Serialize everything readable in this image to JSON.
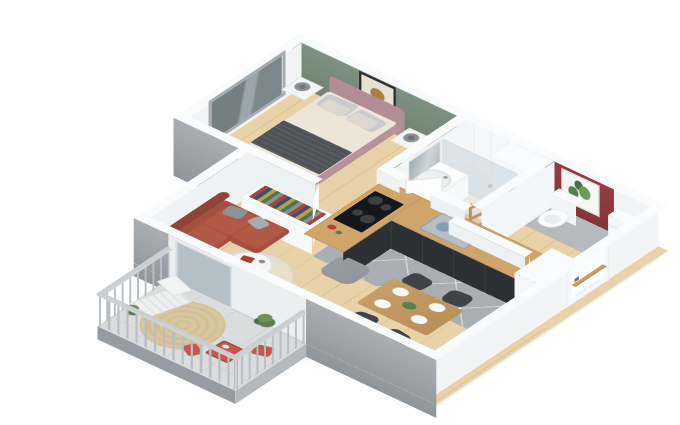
{
  "scene": {
    "type": "isometric-3d-floor-plan-render",
    "description": "3D cutaway floor plan of a one-bedroom apartment with balcony, viewed from above at an angle, on a white background"
  },
  "colors": {
    "background": "#ffffff",
    "wall-top": "#fafbfd",
    "wall-inner": "#f1f3f5",
    "wall-outer": "#a9aeb3",
    "slab": "#969ca1",
    "accent-green": "#7e9080",
    "accent-red": "#943d43",
    "wood-floor": "#e9d2a8",
    "tile-floor": "#a9aeb2",
    "bath-floor": "#eae8e3",
    "wc-tile": "#b6babd",
    "balcony-floor": "#dadcde",
    "glass": "#aab8bf",
    "sofa": "#a5503f",
    "sofa-dark": "#8f4436",
    "bed-frame": "#b28e94",
    "bedding": "#ece5d8",
    "throw-blanket": "#50525a",
    "pillow-gray": "#c9cbce",
    "counter-base": "#2c3034",
    "counter-top": "#cfa56c",
    "cooktop": "#15171a",
    "rug-living": "#e8dfca",
    "rug-balcony": "#d2bf96",
    "rug-bath": "#dccfba",
    "pouf": "#8f959a",
    "table-wood": "#c79f68",
    "chair-dark": "#3f444a",
    "plant-green": "#5d7f4d",
    "bistro-red": "#c4574e",
    "ladder-wood": "#c0925d",
    "art-gold": "#a87f3e",
    "mirror": "#b9c3c7",
    "railing": "#b9bec2"
  },
  "apartment": {
    "rooms": [
      {
        "id": "bedroom",
        "features": [
          "green-accent-wall",
          "gold-abstract-wall-art",
          "sliding-window",
          "double-bed",
          "dark-throw-blanket",
          "pillows",
          "two-nightstands",
          "two-table-lamps",
          "dark-vase"
        ]
      },
      {
        "id": "bathroom",
        "features": [
          "walk-in-shower",
          "glass-shower-screen",
          "sink-vanity",
          "round-mirror-panel",
          "towel-ladder",
          "round-beige-rug"
        ]
      },
      {
        "id": "wc-entry",
        "features": [
          "red-accent-wall",
          "botanical-wall-art",
          "toilet",
          "storage-niche",
          "console-table",
          "front-door"
        ]
      },
      {
        "id": "kitchen",
        "features": [
          "l-shaped-counter",
          "dark-base-cabinets",
          "wood-worktop",
          "four-burner-cooktop",
          "sink-with-dishes",
          "tall-white-cabinet",
          "gray-floor-tiles"
        ]
      },
      {
        "id": "living-dining",
        "features": [
          "terracotta-corner-sofa",
          "gray-cushions",
          "round-coffee-table",
          "round-beige-area-rug",
          "gray-pouf",
          "white-sideboard-with-books",
          "dining-table",
          "four-dark-chairs",
          "four-white-plates",
          "green-centerpiece",
          "glass-balcony-door"
        ]
      },
      {
        "id": "balcony",
        "features": [
          "gray-railing-with-balusters",
          "round-jute-rug",
          "white-lounge-chair",
          "two-potted-plants",
          "red-bistro-table",
          "red-bistro-chairs"
        ]
      }
    ]
  }
}
